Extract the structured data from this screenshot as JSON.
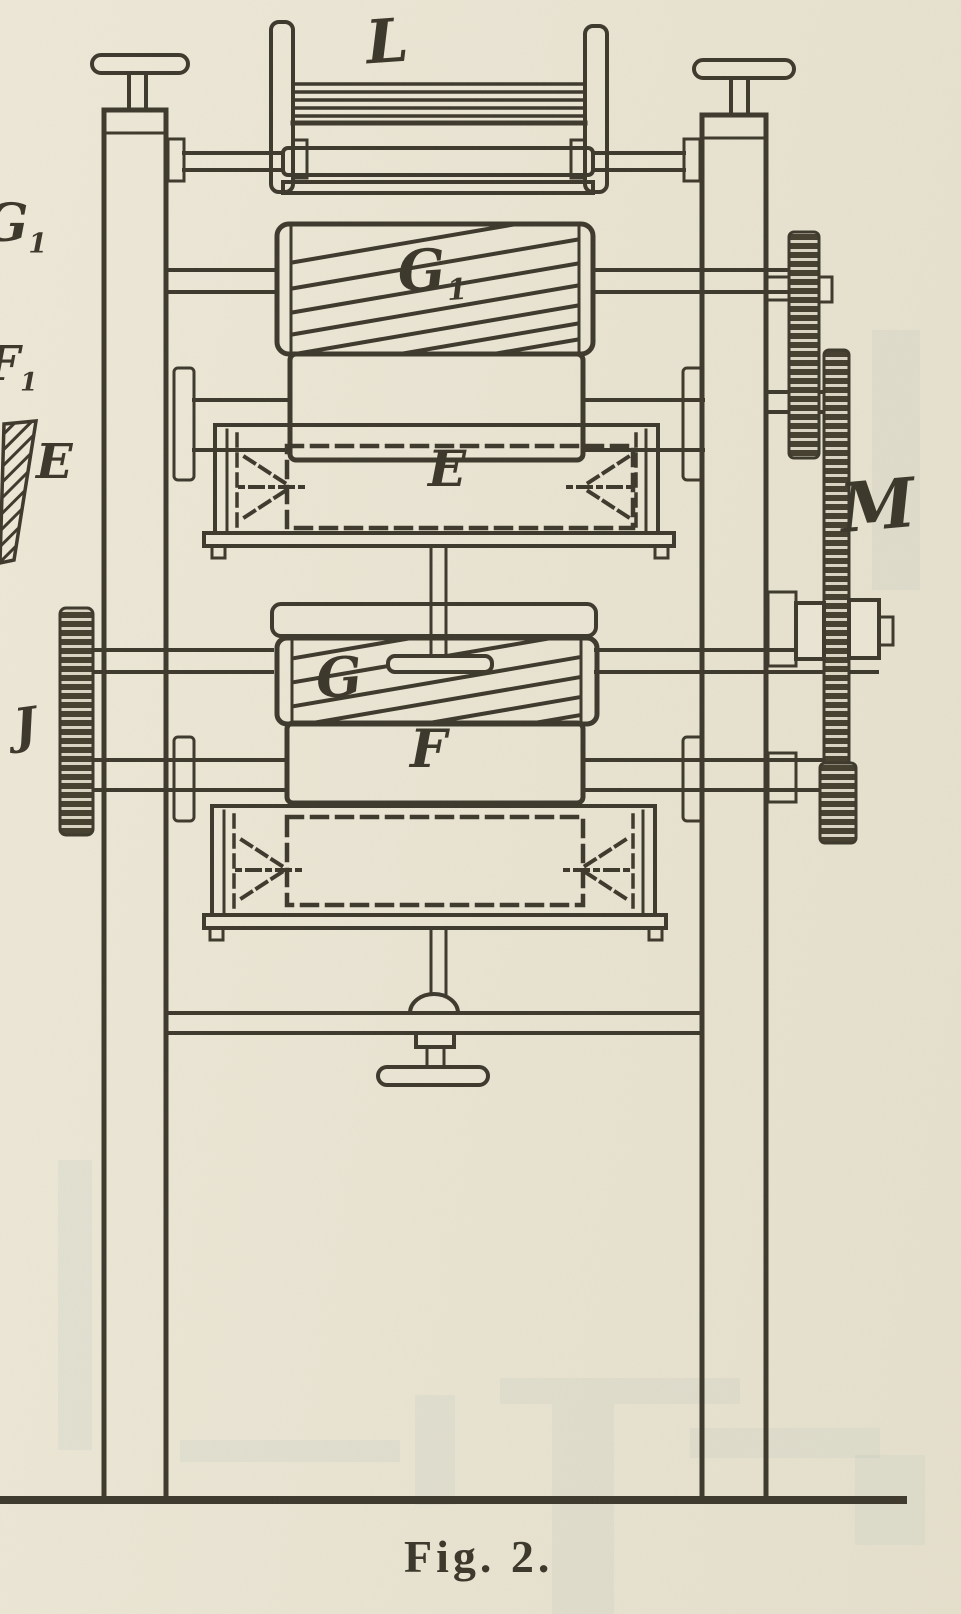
{
  "figure": {
    "caption": "Fig. 2."
  },
  "labels": {
    "top_frame": "L",
    "upper_fluted_roller": {
      "main": "G",
      "sub": "1"
    },
    "upper_tray": "E",
    "middle_fluted_roller": "G",
    "lower_roller": "F",
    "right_gear_train": "M",
    "left_gear": "J",
    "margin_roller_g": {
      "main": "G",
      "sub": "1"
    },
    "margin_roller_f": {
      "main": "F",
      "sub": "1"
    },
    "margin_tray": "E"
  },
  "colors": {
    "paper": "#e9e4d2",
    "ink": "#3d392c",
    "gear_dark": "#45402f",
    "ghost": "#b7c3ba"
  }
}
